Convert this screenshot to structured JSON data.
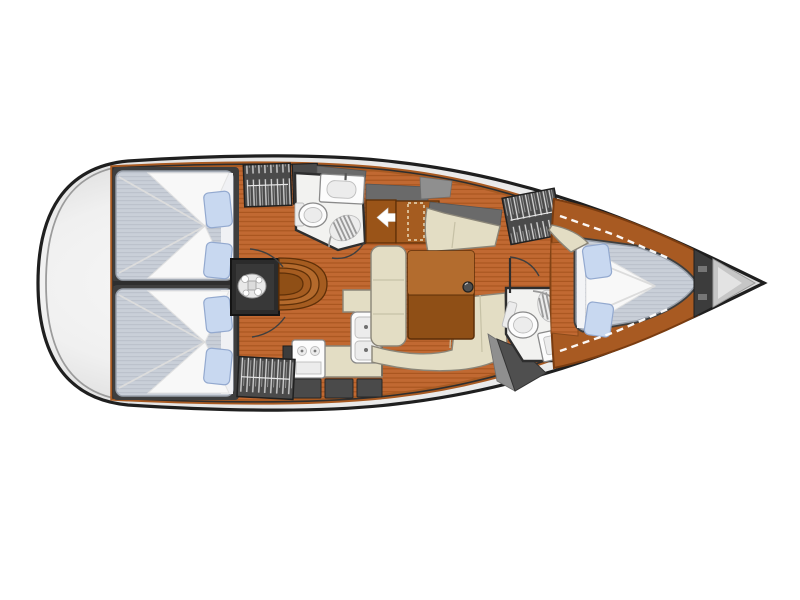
{
  "meta": {
    "type": "sailboat-interior-floor-plan",
    "view": "top-down",
    "orientation": "bow-right"
  },
  "canvas": {
    "width": 800,
    "height": 600
  },
  "colors": {
    "background": "#ffffff",
    "hull_outline": "#1f1f1f",
    "hull_fill_center": "#fbfbfb",
    "hull_fill_mid": "#f0f0f0",
    "hull_fill_edge": "#cccccc",
    "deck_inner_line": "#9b9b9b",
    "floor_wood": "#c16932",
    "floor_stripe": "#a8551e",
    "caprail": "#a85a22",
    "wood_cabinet": "#9a5418",
    "wood_cabinet_light": "#a55c20",
    "wood_table_dark": "#8f4f16",
    "wood_table_light": "#b36c2e",
    "wood_step_light": "#b46a2c",
    "wood_edge": "#5f3008",
    "upholstery_cream": "#e3ddc4",
    "upholstery_edge": "#8a8578",
    "upholstery_seam": "#c6c1a6",
    "mattress": "#c9cfd8",
    "mattress_stripe": "#b7bec9",
    "mattress_edge": "#99a0ab",
    "bedding": "#f8f8f8",
    "bedding_fold": "#dcdcdc",
    "pillow": "#c8d8f0",
    "pillow_edge": "#93a9cf",
    "wall_dark": "#2e2e2e",
    "bulkhead": "#3c3c3c",
    "frame_dark": "#3e3e3e",
    "locker": "#4a4a4a",
    "locker_stripe": "#d8d8d8",
    "roof_gray": "#6a6a6a",
    "roof_gray_light": "#8f8f8f",
    "room_white": "#f2f2f0",
    "fixture_white": "#fcfcfc",
    "fixture_inner": "#ececec",
    "fixture_line": "#8a8a8a",
    "shower_line": "#9a9a9a",
    "engine_box": "#2b2b2b",
    "engine_metal": "#e9e9e9",
    "anchor_gray": "#c6c6c6",
    "anchor_light": "#e3e3e3",
    "dash_white": "#ffffff",
    "dash_tan": "#ead9b8",
    "arrow_white": "#ffffff"
  },
  "regions": {
    "stern": {
      "features": [
        "transom-deck"
      ]
    },
    "aft_cabin_port": {
      "berth": "double",
      "pillows": 2
    },
    "aft_cabin_starboard": {
      "berth": "double",
      "pillows": 2
    },
    "aft_head": {
      "fixtures": [
        "toilet",
        "washbasin",
        "shower-seat"
      ]
    },
    "engine_compartment": {
      "present": true
    },
    "companionway": {
      "steps": 4,
      "entry_arrow_direction": "left"
    },
    "galley": {
      "fixtures": [
        "two-burner-stove",
        "double-sink",
        "l-shaped-counter",
        "storage-lockers"
      ]
    },
    "salon": {
      "settee": "u-shaped",
      "table": "drop-leaf",
      "mast_post": true
    },
    "hanging_lockers": {
      "count": 3
    },
    "forward_head": {
      "fixtures": [
        "toilet",
        "washbasin",
        "shower-seat"
      ]
    },
    "forward_cabin": {
      "berth": "v-berth-double",
      "pillows": 2,
      "seat": 1,
      "shelf_trim": "dashed"
    },
    "bow": {
      "features": [
        "chain-locker"
      ]
    }
  }
}
